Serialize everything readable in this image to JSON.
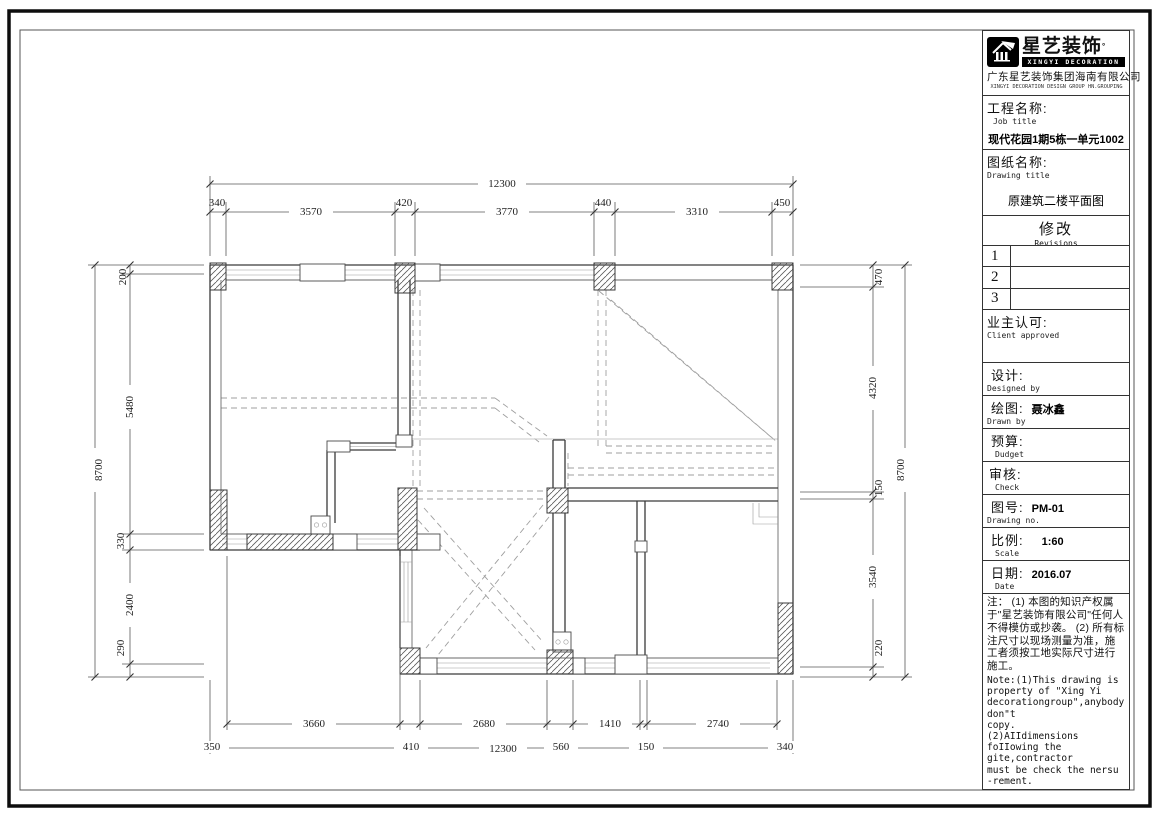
{
  "brand": {
    "name_cn": "星艺装饰",
    "reg": "°",
    "bar": "XINGYI DECORATION",
    "company_cn": "广东星艺装饰集团海南有限公司",
    "company_en": "XINGYI DECORATION DESIGN GROUP HN.GROUPING"
  },
  "fields": {
    "job": {
      "cn": "工程名称:",
      "en": "Job title",
      "value": "现代花园1期5栋一单元1002"
    },
    "drawing": {
      "cn": "图纸名称:",
      "en": "Drawing title",
      "value": "原建筑二楼平面图"
    },
    "revisions": {
      "cn": "修改",
      "en": "Revisions",
      "rows": [
        "1",
        "2",
        "3"
      ]
    },
    "client": {
      "cn": "业主认可:",
      "en": "Client approved"
    },
    "designed": {
      "cn": "设计:",
      "en": "Designed by",
      "value": ""
    },
    "drawn": {
      "cn": "绘图:",
      "en": "Drawn by",
      "value": "聂冰鑫"
    },
    "budget": {
      "cn": "预算:",
      "en": "Dudget",
      "value": ""
    },
    "check": {
      "cn": "审核:",
      "en": "Check",
      "value": ""
    },
    "no": {
      "cn": "图号:",
      "en": "Drawing no.",
      "value": "PM-01"
    },
    "scale": {
      "cn": "比例:",
      "en": "Scale",
      "value": "1:60"
    },
    "date": {
      "cn": "日期:",
      "en": "Date",
      "value": "2016.07"
    }
  },
  "notes": {
    "cn": "注： (1) 本图的知识产权属于\"星艺装饰有限公司\"任何人不得模仿或抄袭。 (2) 所有标注尺寸以现场测量为准，施工者须按工地实际尺寸进行施工。",
    "en": "Note:(1)This drawing is\nproperty of \"Xing Yi\ndecorationgroup\",anybody don\"t\ncopy.\n      (2)AIIdimensions\nfoIIowing the gite,contractor\nmust be check the nersu\n-rement."
  },
  "plan": {
    "dims": {
      "top_overall": "12300",
      "top": [
        "340",
        "3570",
        "420",
        "3770",
        "440",
        "3310",
        "450"
      ],
      "left_overall": "8700",
      "left": [
        "200",
        "5480",
        "330",
        "2400",
        "290"
      ],
      "right_overall": "8700",
      "right": [
        "470",
        "4320",
        "150",
        "3540",
        "220"
      ],
      "bottom_inner": [
        "3660",
        "2680",
        "1410",
        "2740"
      ],
      "bottom_outer": [
        "350",
        "410",
        "12300",
        "560",
        "150",
        "340"
      ]
    }
  }
}
